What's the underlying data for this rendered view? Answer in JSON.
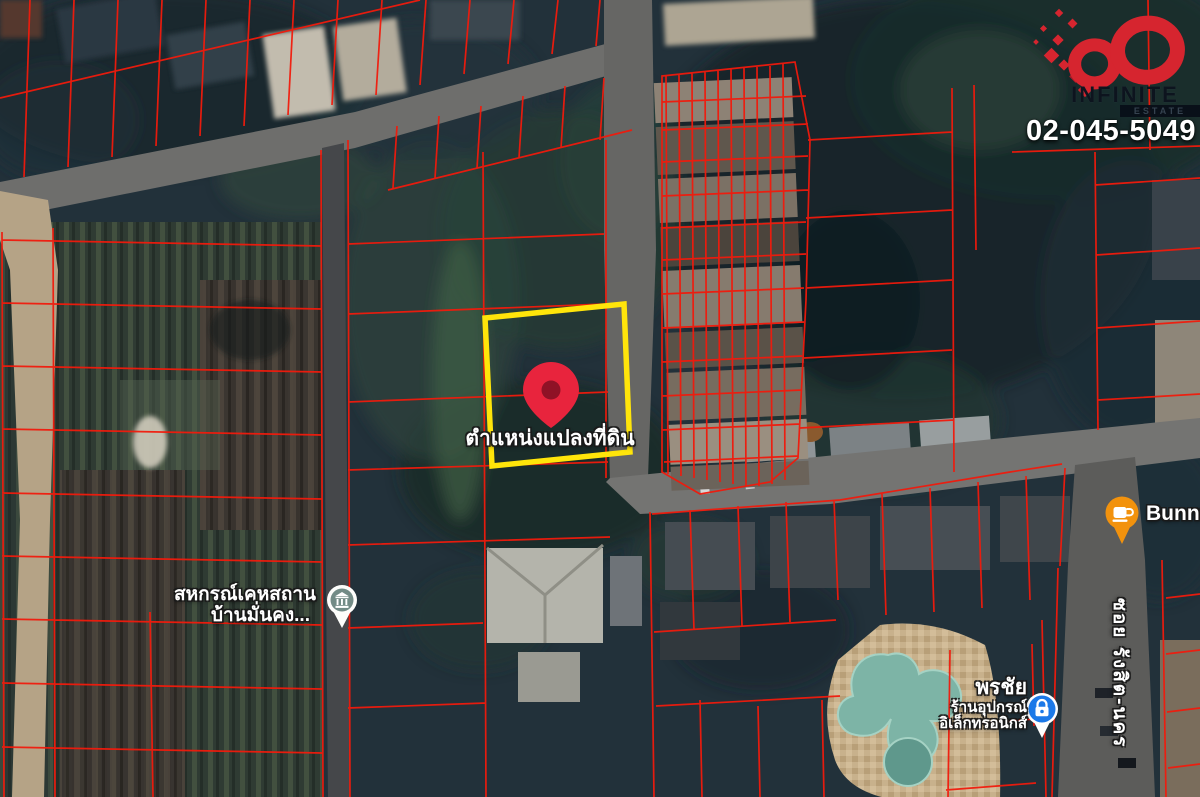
{
  "brand": {
    "logo_title": "INFINITE",
    "logo_subtitle": "ESTATE",
    "phone": "02-045-5049",
    "accent_color": "#d6252f"
  },
  "map": {
    "target_plot": {
      "label": "ตำแหน่งแปลงที่ดิน",
      "highlight_color": "#ffe50a",
      "pin_color": "#e8243d"
    },
    "pois": {
      "housing_coop": {
        "icon": "bank-icon",
        "line1": "สหกรณ์เคหสถาน",
        "line2": "บ้านมั่นคง..."
      },
      "cafe": {
        "icon": "coffee-icon",
        "label": "BunnCh",
        "pin_color": "#f2920d"
      },
      "electronics": {
        "icon": "shopping-icon",
        "line1": "พรชัย",
        "line2": "ร้านอุปกรณ์",
        "line3": "อิเล็กทรอนิกส์",
        "pin_color": "#1c79e8"
      }
    },
    "road_label": "ซอย รังสิต-นคร",
    "parcel_line_color": "#f11a0c"
  }
}
